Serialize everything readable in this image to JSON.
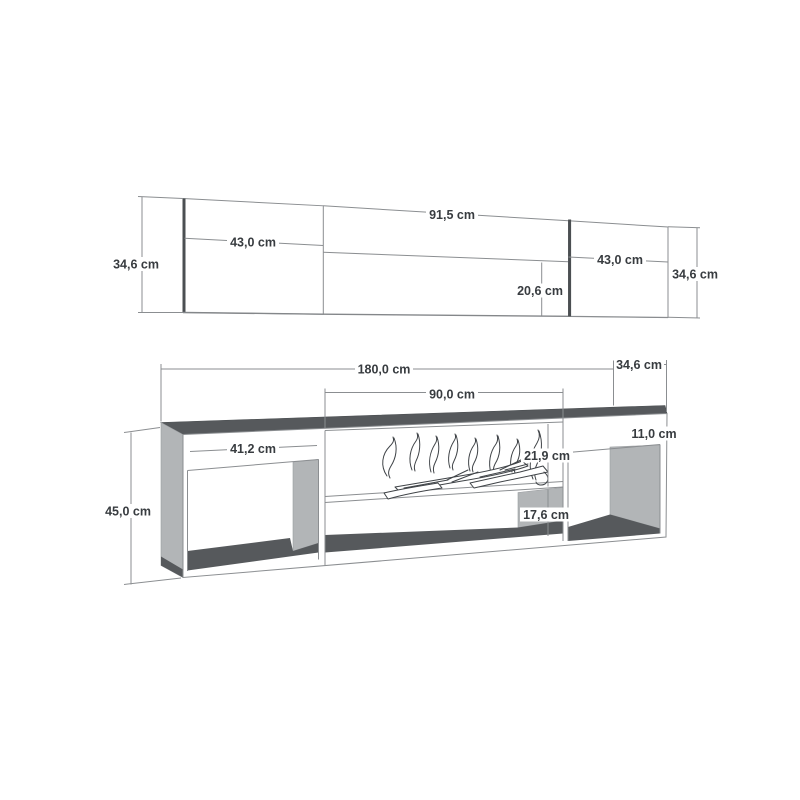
{
  "colors": {
    "background": "#ffffff",
    "line": "#8b8e91",
    "edge": "#4b4f52",
    "surface_dark": "#56595c",
    "surface_light": "#b2b5b7",
    "text": "#383c40",
    "sketch": "#3f4347"
  },
  "wall_panels": {
    "side_height": "34,6 cm",
    "left_width": "43,0 cm",
    "middle_width": "91,5 cm",
    "middle_height": "20,6 cm",
    "right_width": "43,0 cm",
    "right_height": "34,6 cm"
  },
  "tv_stand": {
    "width": "180,0 cm",
    "depth": "34,6 cm",
    "fireplace_width": "90,0 cm",
    "left_compartment_width": "41,2 cm",
    "top_panel_height": "11,0 cm",
    "firebox_height": "21,9 cm",
    "shelf_height": "17,6 cm",
    "height": "45,0 cm"
  }
}
